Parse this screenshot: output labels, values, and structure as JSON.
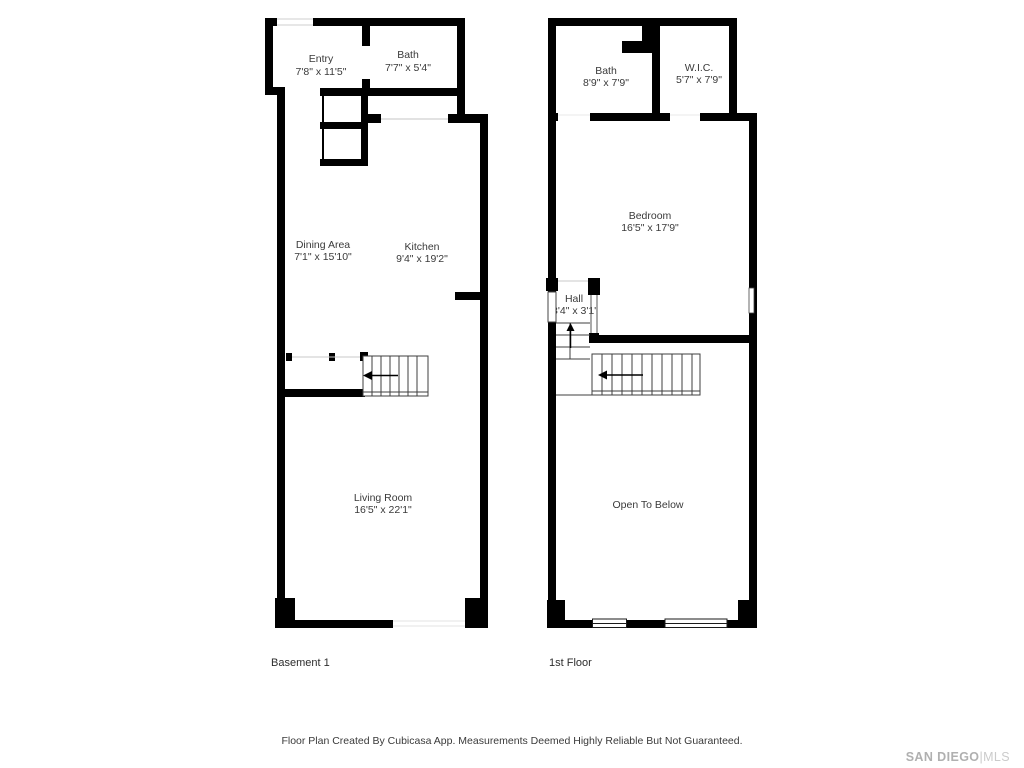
{
  "canvas": {
    "width": 1024,
    "height": 768,
    "background": "#ffffff"
  },
  "colors": {
    "wall": "#000000",
    "room_text": "#3a3a3a",
    "floor_label_text": "#2d2d2d",
    "disclaimer_text": "#3a3a3a",
    "stair_line": "#3f3f3f",
    "light_line": "#d9d9d9",
    "logo_gray": "#b0b0b0",
    "logo_light_gray": "#cbcbcb"
  },
  "plans": [
    {
      "floor_label": "Basement 1",
      "rooms": [
        {
          "name": "Entry",
          "dims": "7'8\" x 11'5\""
        },
        {
          "name": "Bath",
          "dims": "7'7\" x 5'4\""
        },
        {
          "name": "Dining Area",
          "dims": "7'1\" x 15'10\""
        },
        {
          "name": "Kitchen",
          "dims": "9'4\" x 19'2\""
        },
        {
          "name": "Living Room",
          "dims": "16'5\" x 22'1\""
        }
      ]
    },
    {
      "floor_label": "1st Floor",
      "rooms": [
        {
          "name": "Bath",
          "dims": "8'9\" x 7'9\""
        },
        {
          "name": "W.I.C.",
          "dims": "5'7\" x 7'9\""
        },
        {
          "name": "Bedroom",
          "dims": "16'5\" x 17'9\""
        },
        {
          "name": "Hall",
          "dims": "3'4\" x 3'1\""
        },
        {
          "name": "Open To Below",
          "dims": ""
        }
      ]
    }
  ],
  "footer": {
    "disclaimer": "Floor Plan Created By Cubicasa App. Measurements Deemed Highly Reliable But Not Guaranteed."
  },
  "logo": {
    "primary": "SAN DIEGO",
    "separator": "|",
    "secondary": "MLS"
  }
}
